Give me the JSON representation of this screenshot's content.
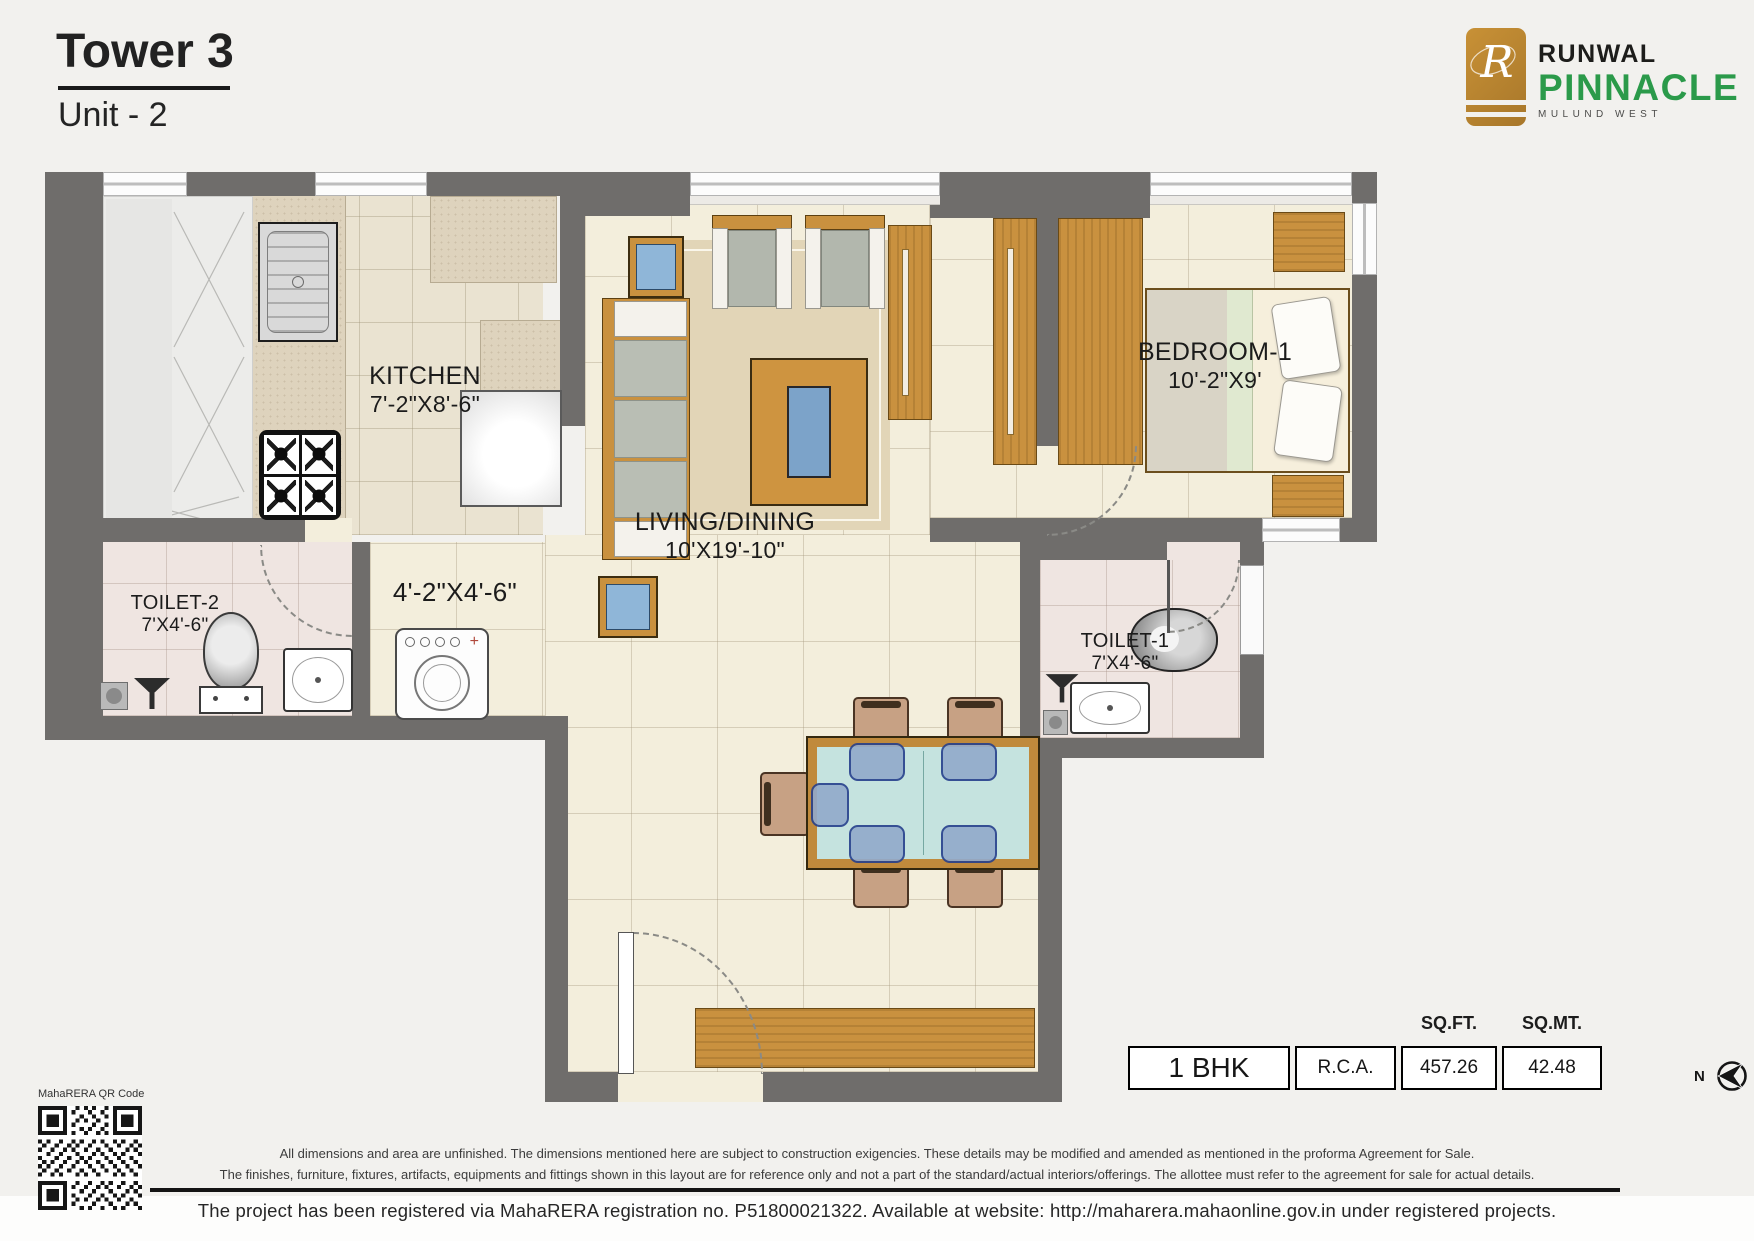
{
  "header": {
    "tower": "Tower 3",
    "unit": "Unit - 2"
  },
  "logo": {
    "monogram": "R",
    "brand": "RUNWAL",
    "project": "PINNACLE",
    "location": "MULUND WEST",
    "colors": {
      "gold": "#b8842f",
      "green": "#2b9a4a"
    }
  },
  "plan": {
    "kitchen": {
      "name": "KITCHEN",
      "dim": "7'-2\"X8'-6\""
    },
    "living": {
      "name": "LIVING/DINING",
      "dim": "10'X19'-10\""
    },
    "bedroom": {
      "name": "BEDROOM-1",
      "dim": "10'-2\"X9'"
    },
    "toilet2": {
      "name": "TOILET-2",
      "dim": "7'X4'-6\""
    },
    "toilet1": {
      "name": "TOILET-1",
      "dim": "7'X4'-6\""
    },
    "passage": {
      "dim": "4'-2\"X4'-6\""
    }
  },
  "area_table": {
    "sqft_header": "SQ.FT.",
    "sqmt_header": "SQ.MT.",
    "unit_type": "1 BHK",
    "basis": "R.C.A.",
    "sqft_value": "457.26",
    "sqmt_value": "42.48"
  },
  "compass": {
    "label": "N"
  },
  "qr": {
    "label": "MahaRERA QR Code"
  },
  "footer": {
    "disclaimer_line1": "All dimensions and area are unfinished. The dimensions mentioned here are subject to construction exigencies. These details may be modified and amended as mentioned in the proforma Agreement for Sale.",
    "disclaimer_line2": "The finishes, furniture, fixtures, artifacts, equipments and fittings shown in this layout are for reference only and not a part of the standard/actual interiors/offerings. The allottee must refer to the agreement for sale for actual details.",
    "rera_line": "The project has been registered via MahaRERA registration no. P51800021322. Available at website: http://maharera.mahaonline.gov.in under registered projects."
  }
}
